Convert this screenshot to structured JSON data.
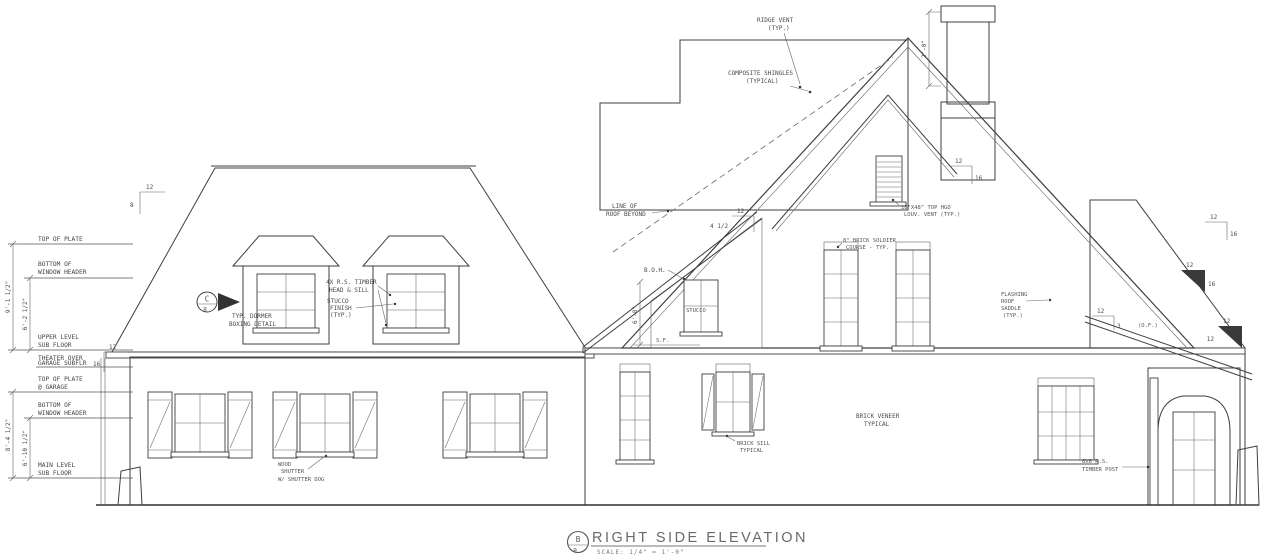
{
  "drawing": {
    "title": "RIGHT SIDE ELEVATION",
    "scale_note": "SCALE: 1/4\" = 1'-0\"",
    "detail_bubble": {
      "top": "B",
      "bottom": "9"
    },
    "dormer_bubble": {
      "top": "C",
      "bottom": "8"
    }
  },
  "levels": {
    "top_of_plate": "TOP OF PLATE",
    "bottom_header_upper_1": "BOTTOM OF",
    "bottom_header_upper_2": "WINDOW HEADER",
    "upper_sub_1": "UPPER LEVEL",
    "upper_sub_2": "SUB FLOOR",
    "theater_1": "THEATER OVER",
    "theater_2": "GARAGE SUBFLR",
    "garage_plate_1": "TOP OF PLATE",
    "garage_plate_2": "@ GARAGE",
    "bottom_header_main_1": "BOTTOM OF",
    "bottom_header_main_2": "WINDOW HEADER",
    "main_sub_1": "MAIN LEVEL",
    "main_sub_2": "SUB FLOOR"
  },
  "dimensions": {
    "upper_overall": "9'-1 1/2\"",
    "upper_header": "6'-2 1/2\"",
    "main_overall": "8'-4 1/2\"",
    "main_header": "6'-10 1/2\"",
    "chimney_height": "2'-0\"",
    "header_to_subfloor": "6'-8\""
  },
  "notes": {
    "ridge_vent_1": "RIDGE VENT",
    "ridge_vent_2": "(TYP.)",
    "shingles_1": "COMPOSITE SHINGLES",
    "shingles_2": "(TYPICAL)",
    "roof_beyond_1": "LINE OF",
    "roof_beyond_2": "ROOF BEYOND",
    "timber_head_1": "4X R.S. TIMBER",
    "timber_head_2": "HEAD & SILL",
    "stucco_finish_1": "STUCCO",
    "stucco_finish_2": "FINISH",
    "stucco_finish_3": "(TYP.)",
    "dormer_detail_1": "TYP. DORMER",
    "dormer_detail_2": "BOXING DETAIL",
    "boh": "B.O.H.",
    "stucco": "STUCCO",
    "sf": "S.F.",
    "louver_1": "18\"X48\" TOP HGD",
    "louver_2": "LOUV. VENT (TYP.)",
    "soldier_1": "8\" BRICK SOLDIER",
    "soldier_2": "COURSE - TYP.",
    "flashing_1": "FLASHING",
    "flashing_2": "ROOF",
    "flashing_3": "SADDLE",
    "flashing_4": "(TYP.)",
    "veneer_1": "BRICK VENEER",
    "veneer_2": "TYPICAL",
    "sill_1": "BRICK SILL",
    "sill_2": "TYPICAL",
    "shutter_1": "WOOD",
    "shutter_2": "SHUTTER",
    "shutter_3": "W/ SHUTTER DOG",
    "post_1": "6X6 R.S.",
    "post_2": "TIMBER POST",
    "of_note": "(O.F.)"
  },
  "pitch_markers": {
    "left_roof": {
      "run": "12",
      "rise": "8"
    },
    "theater_roof": {
      "run": "12",
      "rise": "16"
    },
    "shed_roof": {
      "run": "12",
      "rise": "4 1/2"
    },
    "gable_roof": {
      "run": "12",
      "rise": "16"
    },
    "right_eave": {
      "run": "12",
      "rise": "16"
    },
    "right_tri_upper": {
      "run": "12",
      "rise": "16"
    },
    "right_tri_lower": {
      "run": "12",
      "rise": "12"
    },
    "porch_roof": {
      "run": "12",
      "rise": "3"
    }
  },
  "colors": {
    "line": "#3f3f3f",
    "hatch": "#bbbbbb",
    "text": "#4a4a4a"
  }
}
